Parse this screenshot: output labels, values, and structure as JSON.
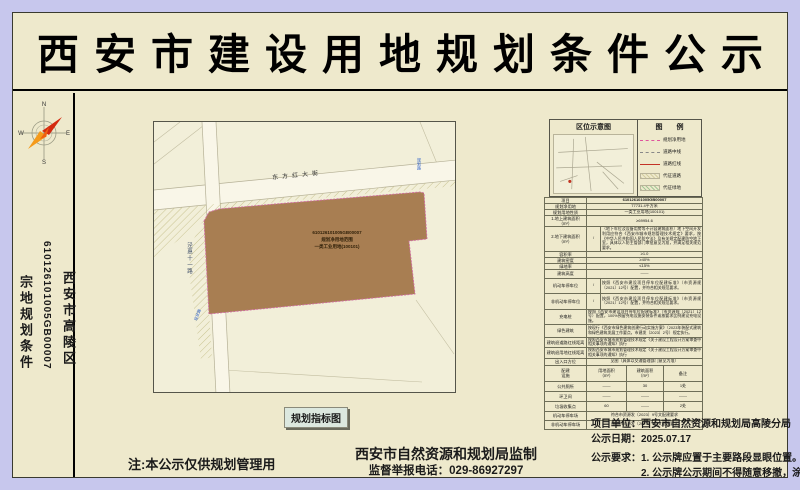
{
  "title": "西安市建设用地规划条件公示",
  "left_strip": {
    "doc_type": "宗地规划条件",
    "parcel_no": "610126101005GB00007",
    "district": "西安市高陵区",
    "compass": {
      "n": "N",
      "e": "E",
      "s": "S",
      "w": "W"
    }
  },
  "map": {
    "road_top_label": "东方红大街",
    "road_left_label": "泾惠十一路",
    "blue_label_tr": "规划路",
    "blue_label_bl": "现状路",
    "parcel_text_line1": "610126101005GB00007",
    "parcel_text_line2": "规划净用地范围",
    "parcel_text_line3": "一类工业用地(100101)",
    "caption": "规划指标图"
  },
  "location_panel": {
    "title": "区位示意图"
  },
  "legend": {
    "title": "图  例",
    "items": [
      {
        "label": "规划净用地"
      },
      {
        "label": "道路中线"
      },
      {
        "label": "道路红线"
      },
      {
        "label": "代征道路"
      },
      {
        "label": "代征绿地"
      }
    ]
  },
  "table": {
    "rows": [
      {
        "label": "项目",
        "value": "610126101005GB00007"
      },
      {
        "label": "规划净用地",
        "value": "77731.4平方米"
      },
      {
        "label": "规划用地性质",
        "value": "一类工业用地(100101)"
      },
      {
        "label": "1.地上建筑面积（m²）",
        "value": "≥69954.6"
      },
      {
        "label": "2.地下建筑面积（m²）",
        "mid": "/",
        "value": "（地下车位及设备用房等不计容建筑面积）地下空间开发利用应符合《西安市城市规划管理技术规定》要求，按《中华人民共和国人民防空法》及有关规定配建防空地下室，具体以人防主管部门审批意见为准，并满足相关规范要求。"
      },
      {
        "label": "容积率",
        "value": "≥1.0"
      },
      {
        "label": "建筑密度",
        "value": "≥40%"
      },
      {
        "label": "绿地率",
        "value": "≤15%"
      },
      {
        "label": "建筑高度",
        "value": "——"
      },
      {
        "label": "机动车停车位",
        "mid": "/",
        "value": "按照《西安市建设项目停车位配建标准》（市资源规〔2021〕12号）配置，并符合相关规范要求。"
      },
      {
        "label": "非机动车停车位",
        "mid": "/",
        "value": "按照《西安市建设项目停车位配建标准》（市资源规〔2021〕12号）配置，并符合相关规范要求。"
      },
      {
        "label": "充电桩",
        "value": "按照《西安市建设项目停车位配建标准》（市资源规〔2021〕12号）配置，100%预留充电设施安装条件或按要求比例建设充电设施。"
      },
      {
        "label": "绿色建筑",
        "value": "按现行《西安市绿色建筑创建行动实施方案》（2023年装配式建筑和绿色建筑发展工作要点，市建发〔2023〕2号）规定执行。"
      },
      {
        "label": "建筑退道路红线距离",
        "value": "按照西安市城市规划管理技术规定《关于建设工程设计方案审查中相关事项的通知》执行"
      },
      {
        "label": "建筑退用地红线距离",
        "value": "按照西安市城市规划管理技术规定《关于建设工程设计方案审查中相关事项的通知》执行"
      },
      {
        "label": "出入口方位",
        "value": "见图（具体以交通管理部门意见为准）"
      }
    ]
  },
  "sub_table": {
    "headers": [
      "配建\n设施",
      "用地面积\n（m²）",
      "建筑面积\n（m²）",
      "备注"
    ],
    "rows": [
      {
        "c1": "公共厕所",
        "c2": "——",
        "c3": "30",
        "c4": "1处"
      },
      {
        "c1": "环卫间",
        "c2": "——",
        "c3": "——",
        "c4": "——"
      },
      {
        "c1": "垃圾收集点",
        "c2": "60",
        "c3": "——",
        "c4": "2处"
      }
    ],
    "span_rows": [
      {
        "label": "机动车停车场",
        "value": "符合市资源发〔2023〕9号文配建要求"
      },
      {
        "label": "非机动车停车场",
        "value": "符合市资源发〔2023〕9号文配建要求"
      }
    ]
  },
  "footer": {
    "note": "注:本公示仅供规划管理用",
    "made_by": "西安市自然资源和规划局监制",
    "hotline": "监督举报电话：029-86927297",
    "project_unit": "项目单位：西安市自然资源和规划局高陵分局",
    "publish_date": "公示日期：2025.07.17",
    "requirement_line1": "公示要求：1. 公示牌应置于主要路段显眼位置。",
    "requirement_line2": "2. 公示牌公示期间不得随意移撤，涂改。"
  }
}
